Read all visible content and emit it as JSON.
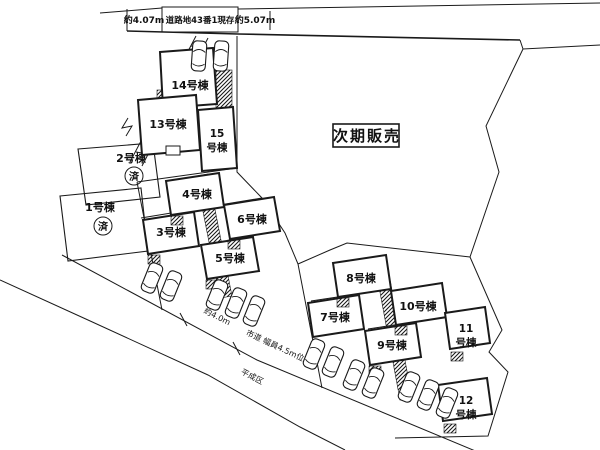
{
  "colors": {
    "ink": "#1a1a1a",
    "paper": "#ffffff"
  },
  "top_road": {
    "left_width": "約4.07m",
    "parcel_note": "道路地43番1現存",
    "right_width": "約5.07m"
  },
  "future_sale": {
    "label": "次期販売"
  },
  "sold_mark": "済",
  "lots": [
    {
      "no": "1",
      "label": "1号棟",
      "sold": true
    },
    {
      "no": "2",
      "label": "2号棟",
      "sold": true
    },
    {
      "no": "3",
      "label": "3号棟"
    },
    {
      "no": "4",
      "label": "4号棟"
    },
    {
      "no": "5",
      "label": "5号棟"
    },
    {
      "no": "6",
      "label": "6号棟"
    },
    {
      "no": "7",
      "label": "7号棟"
    },
    {
      "no": "8",
      "label": "8号棟"
    },
    {
      "no": "9",
      "label": "9号棟"
    },
    {
      "no": "10",
      "label": "10号棟"
    },
    {
      "no": "11",
      "label": "11号棟",
      "line1": "11",
      "line2": "号棟"
    },
    {
      "no": "12",
      "label": "12号棟",
      "line1": "12",
      "line2": "号棟"
    },
    {
      "no": "13",
      "label": "13号棟"
    },
    {
      "no": "14",
      "label": "14号棟"
    },
    {
      "no": "15",
      "label": "15号棟",
      "line1": "15",
      "line2": "号棟"
    }
  ],
  "road_labels": {
    "width_note": "約4.0m",
    "road_note": "市道 幅員4.5m位",
    "area_note": "平成区"
  },
  "icons": {
    "car": "plan-view parked car outline",
    "hatch": "diagonal-hatched driveway/porch area"
  }
}
